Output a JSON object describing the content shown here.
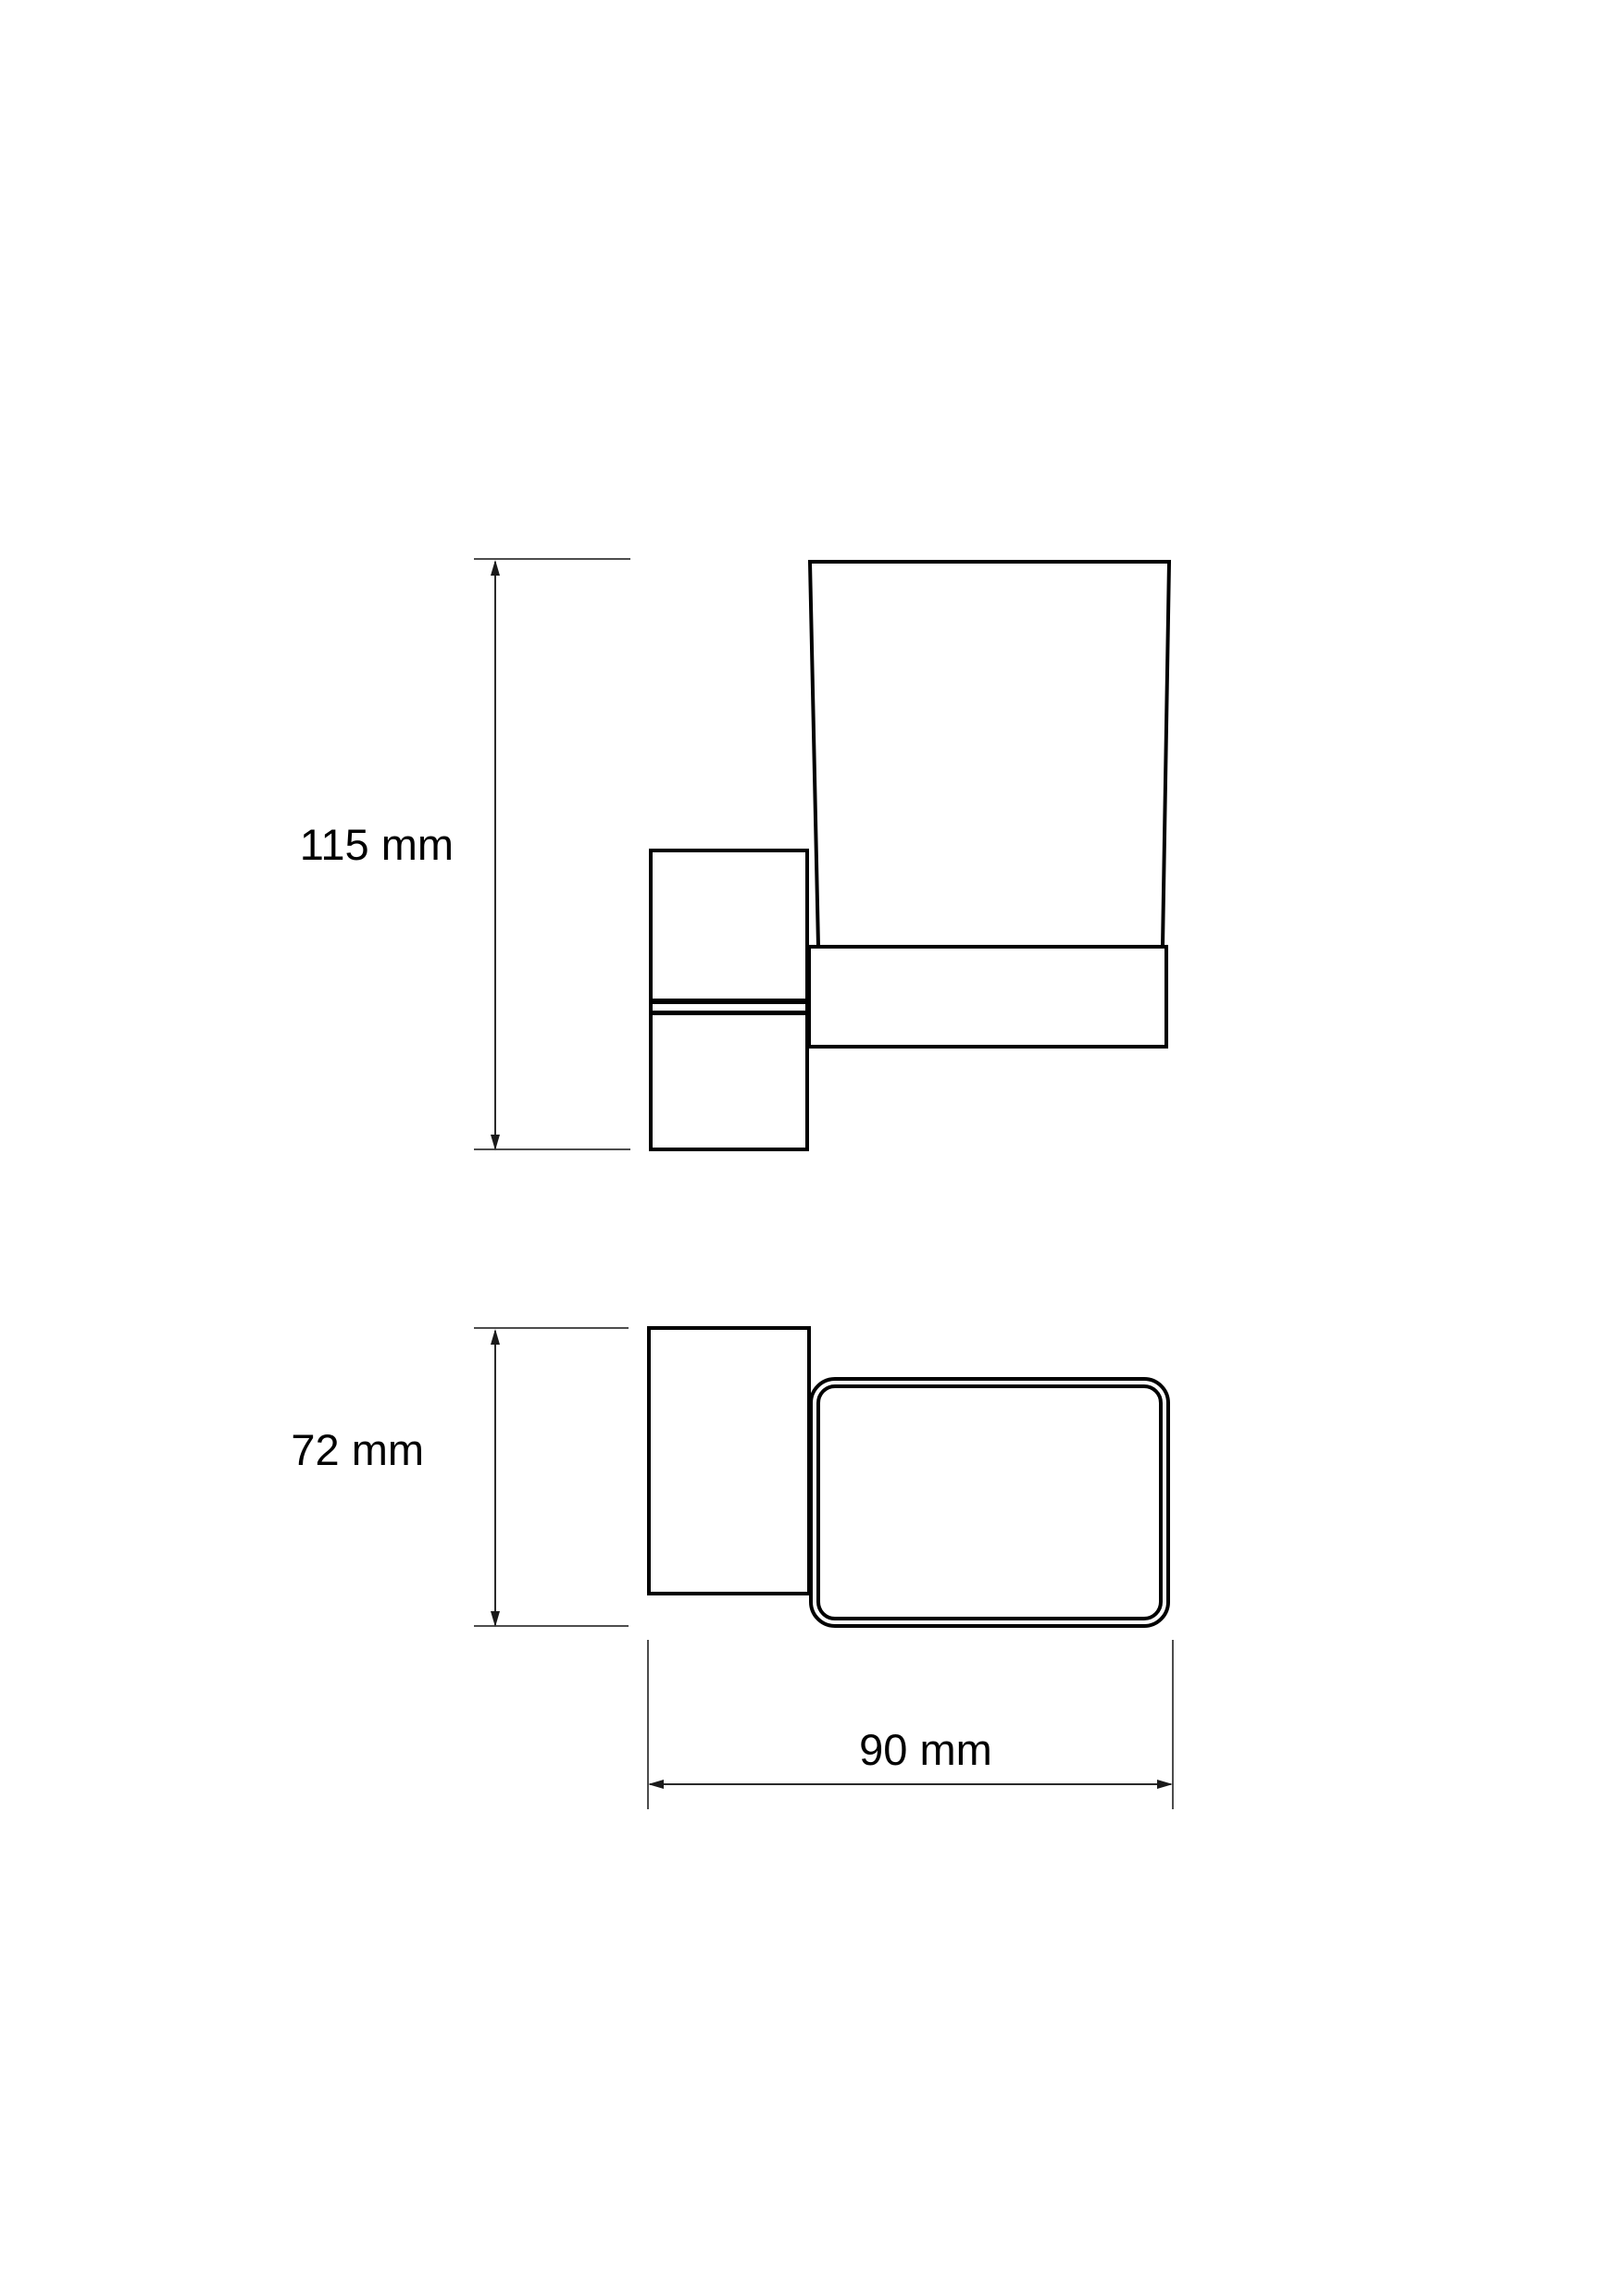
{
  "drawing": {
    "background_color": "#ffffff",
    "line_color": "#000000",
    "dimension_line_color": "#2a2a2a"
  },
  "side_view": {
    "height_label": "115 mm"
  },
  "top_view": {
    "depth_label": "72 mm",
    "width_label": "90 mm"
  }
}
